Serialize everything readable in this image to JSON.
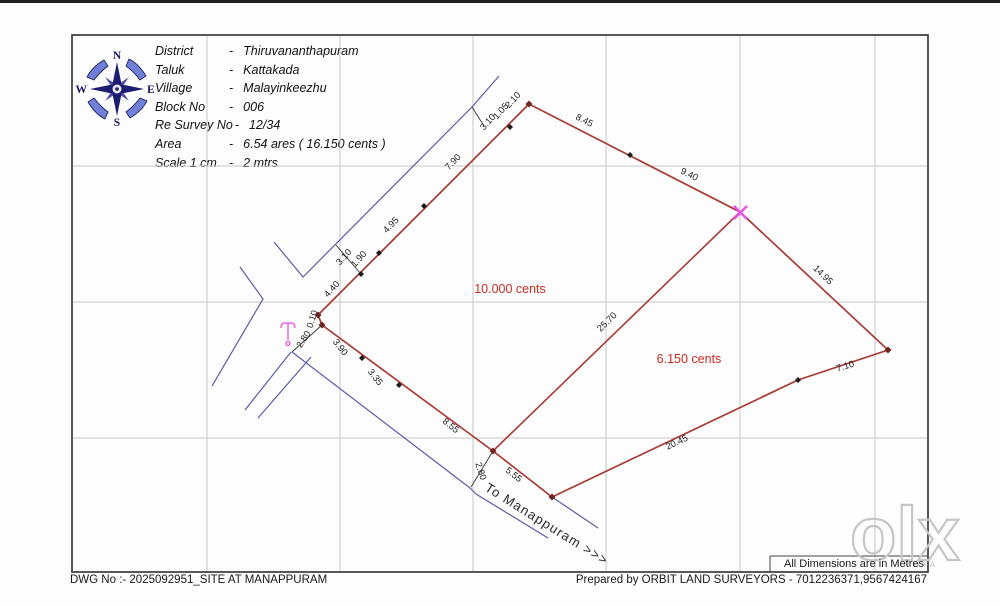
{
  "header": {
    "separator": "-",
    "rows": [
      {
        "label": "District",
        "value": "Thiruvananthapuram"
      },
      {
        "label": "Taluk",
        "value": "Kattakada"
      },
      {
        "label": "Village",
        "value": "Malayinkeezhu"
      },
      {
        "label": "Block No",
        "value": "006"
      },
      {
        "label": "Re Survey No",
        "value": "12/34"
      },
      {
        "label": "Area",
        "value": "6.54 ares ( 16.150 cents )"
      },
      {
        "label": "Scale 1 cm",
        "value": "2 mtrs"
      }
    ]
  },
  "compass": {
    "north": "N",
    "east": "E",
    "south": "S",
    "west": "W"
  },
  "plot": {
    "area_labels": [
      "10.000 cents",
      "6.150 cents"
    ],
    "dims": [
      "3.10",
      "1.05",
      "2.10",
      "8.45",
      "9.40",
      "14.95",
      "7.10",
      "20.45",
      "25.70",
      "7.90",
      "4.95",
      "3.10",
      "1.90",
      "4.40",
      "0.10",
      "2.80",
      "3.90",
      "3.35",
      "8.55",
      "2.80",
      "5.55"
    ],
    "road_label": "To Manappuram >>>"
  },
  "colors": {
    "boundary_red": "#a93b35",
    "road_blue": "#5c5ca8",
    "area_text_red": "#cc2a22",
    "marker_magenta": "#e94fe9",
    "grid_gray": "#c7c7c7"
  },
  "footer": {
    "dwg_no": "DWG No :- 2025092951_SITE AT MANAPPURAM",
    "dims_note": "All Dimensions are in Metres",
    "prepared_by": "Prepared by ORBIT LAND SURVEYORS - 7012236371,9567424167"
  },
  "watermark": {
    "brand": "olx",
    "region": "INDIA"
  }
}
